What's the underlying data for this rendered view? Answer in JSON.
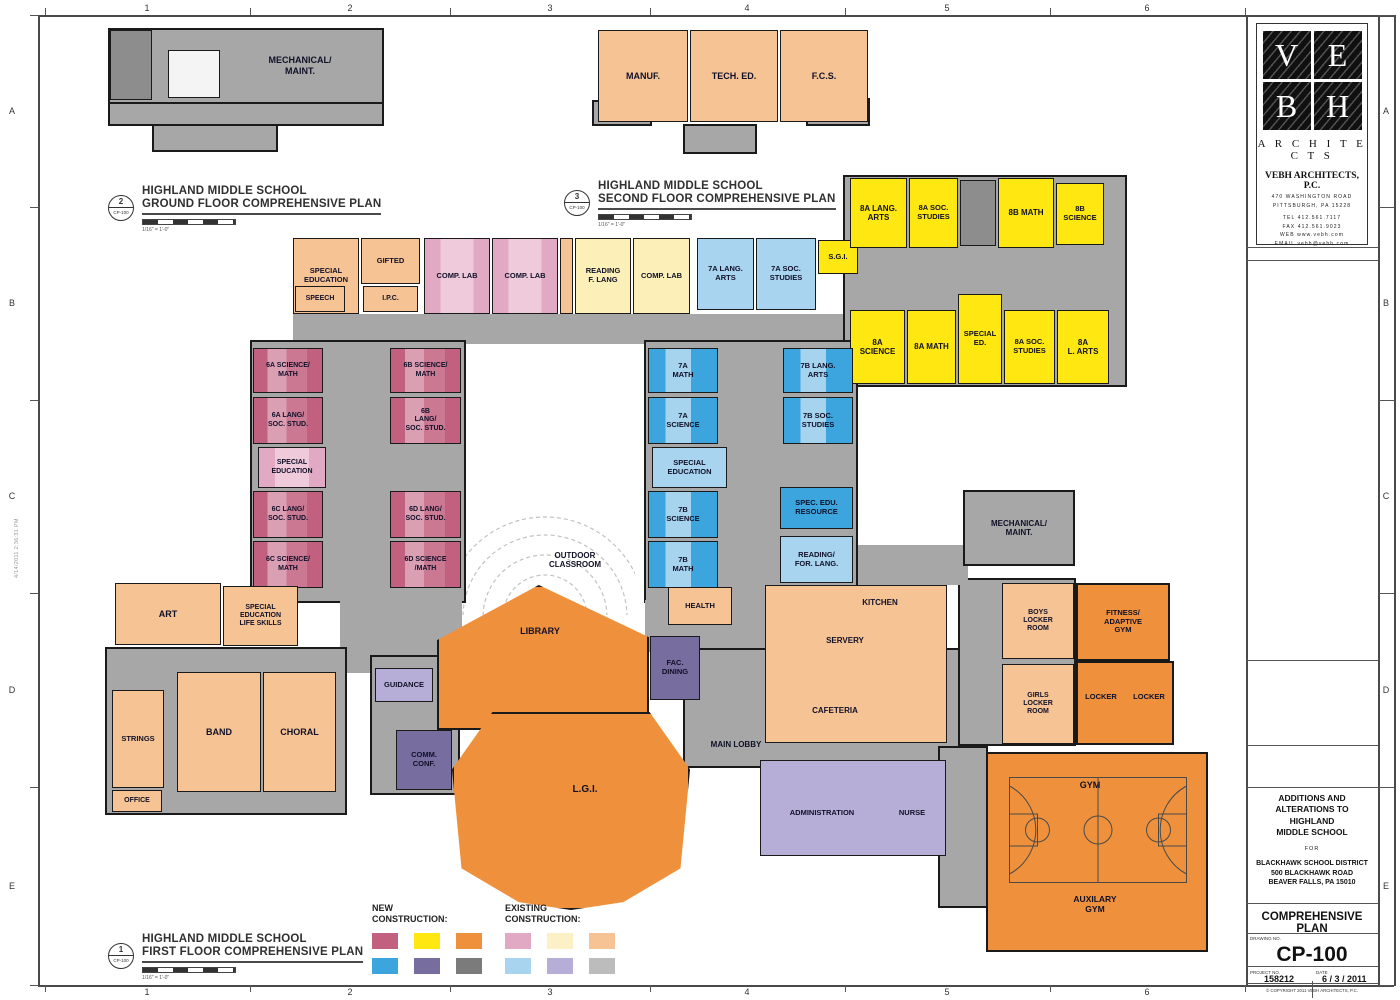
{
  "sheet": {
    "grid_cols": [
      "1",
      "2",
      "3",
      "4",
      "5",
      "6"
    ],
    "grid_rows": [
      "A",
      "B",
      "C",
      "D",
      "E"
    ],
    "stamp": "4/14/2011   2:36:31 PM"
  },
  "titleblock": {
    "logo": [
      "V",
      "E",
      "B",
      "H"
    ],
    "brand": "A R C H I T E C T S",
    "firm": "VEBH ARCHITECTS, P.C.",
    "address1": "470 WASHINGTON ROAD",
    "address2": "PITTSBURGH, PA 15228",
    "tel": "TEL  412.561.7117",
    "fax": "FAX  412.561.9023",
    "web": "WEB  www.vebh.com",
    "email": "EMAIL  vebh@vebh.com",
    "project_title": "ADDITIONS AND\nALTERATIONS TO HIGHLAND\nMIDDLE SCHOOL",
    "for_label": "FOR",
    "client": "BLACKHAWK SCHOOL DISTRICT\n500 BLACKHAWK ROAD\nBEAVER FALLS, PA 15010",
    "sheet_title": "COMPREHENSIVE PLAN",
    "drawing_no_label": "DRAWING NO.",
    "drawing_no": "CP-100",
    "project_no_label": "PROJECT NO.",
    "project_no": "158212",
    "date_label": "DATE",
    "date": "6 / 3 / 2011",
    "copyright": "© COPYRIGHT 2011  VEBH ARCHITECTS, P.C."
  },
  "plan_titles": [
    {
      "num": "2",
      "sheet": "CP-100",
      "line1": "HIGHLAND MIDDLE SCHOOL",
      "line2": "GROUND FLOOR COMPREHENSIVE PLAN",
      "scale": "1/16\" = 1'-0\"",
      "x": 108,
      "y": 185
    },
    {
      "num": "3",
      "sheet": "CP-100",
      "line1": "HIGHLAND MIDDLE SCHOOL",
      "line2": "SECOND FLOOR COMPREHENSIVE PLAN",
      "scale": "1/16\" = 1'-0\"",
      "x": 564,
      "y": 180
    },
    {
      "num": "1",
      "sheet": "CP-100",
      "line1": "HIGHLAND MIDDLE SCHOOL",
      "line2": "FIRST FLOOR COMPREHENSIVE PLAN",
      "scale": "1/16\" = 1'-0\"",
      "x": 108,
      "y": 933
    }
  ],
  "legend": {
    "new_label": "NEW\nCONSTRUCTION:",
    "existing_label": "EXISTING\nCONSTRUCTION:",
    "new_colors": [
      "#c2607f",
      "#ffe712",
      "#ef913c",
      "#3da5dd",
      "#776d9f",
      "#7b7b7b"
    ],
    "existing_colors": [
      "#e2a9c4",
      "#fcf0c6",
      "#f6c494",
      "#a9d4f0",
      "#b6aed6",
      "#bcbcbc"
    ]
  },
  "rooms": [
    {
      "n": "ground-plan-base",
      "x": 108,
      "y": 28,
      "w": 276,
      "h": 76,
      "c": "g"
    },
    {
      "n": "ground-plan-lower",
      "x": 108,
      "y": 102,
      "w": 276,
      "h": 24,
      "c": "g"
    },
    {
      "n": "ground-plan-tab",
      "x": 152,
      "y": 124,
      "w": 126,
      "h": 28,
      "c": "g"
    },
    {
      "n": "ground-room-dark",
      "x": 110,
      "y": 30,
      "w": 42,
      "h": 70,
      "c": "gd"
    },
    {
      "n": "ground-inset",
      "x": 168,
      "y": 50,
      "w": 52,
      "h": 48,
      "c": "w"
    },
    {
      "n": "second-gray-left",
      "x": 592,
      "y": 100,
      "w": 60,
      "h": 26,
      "c": "g"
    },
    {
      "n": "second-gray-right",
      "x": 806,
      "y": 98,
      "w": 64,
      "h": 28,
      "c": "g"
    },
    {
      "n": "second-tab",
      "x": 683,
      "y": 124,
      "w": 74,
      "h": 30,
      "c": "g"
    },
    {
      "n": "strip-corridor",
      "x": 293,
      "y": 314,
      "w": 565,
      "h": 30,
      "c": "gf"
    },
    {
      "n": "yellow-wing-base",
      "x": 843,
      "y": 175,
      "w": 284,
      "h": 212,
      "c": "g"
    },
    {
      "n": "pink-wing-base",
      "x": 250,
      "y": 340,
      "w": 216,
      "h": 263,
      "c": "g"
    },
    {
      "n": "blue-wing-base",
      "x": 644,
      "y": 340,
      "w": 214,
      "h": 263,
      "c": "g"
    },
    {
      "n": "center-connector",
      "x": 340,
      "y": 598,
      "w": 122,
      "h": 75,
      "c": "gf"
    },
    {
      "n": "music-base",
      "x": 105,
      "y": 647,
      "w": 242,
      "h": 168,
      "c": "g"
    },
    {
      "n": "guidance-base",
      "x": 370,
      "y": 655,
      "w": 90,
      "h": 140,
      "c": "g"
    },
    {
      "n": "blue-lobby-connector",
      "x": 645,
      "y": 600,
      "w": 240,
      "h": 52,
      "c": "gf"
    },
    {
      "n": "main-lobby-base",
      "x": 683,
      "y": 648,
      "w": 302,
      "h": 120,
      "c": "g"
    },
    {
      "n": "locker-base",
      "x": 958,
      "y": 578,
      "w": 118,
      "h": 168,
      "c": "g"
    },
    {
      "n": "gym-corridor",
      "x": 938,
      "y": 746,
      "w": 50,
      "h": 162,
      "c": "g"
    },
    {
      "n": "mech-connector",
      "x": 858,
      "y": 545,
      "w": 110,
      "h": 40,
      "c": "gf"
    },
    {
      "n": "mechanical-maint-first",
      "x": 963,
      "y": 490,
      "w": 112,
      "h": 76,
      "c": "g",
      "l": "MECHANICAL/\nMAINT.",
      "fs": 8
    },
    {
      "n": "manuf",
      "x": 598,
      "y": 30,
      "w": 90,
      "h": 92,
      "c": "ore",
      "l": "MANUF.",
      "fs": 9
    },
    {
      "n": "tech-ed",
      "x": 690,
      "y": 30,
      "w": 88,
      "h": 92,
      "c": "ore",
      "l": "TECH. ED.",
      "fs": 9
    },
    {
      "n": "fcs",
      "x": 780,
      "y": 30,
      "w": 88,
      "h": 92,
      "c": "ore",
      "l": "F.C.S.",
      "fs": 9
    },
    {
      "n": "special-education-2f",
      "x": 293,
      "y": 238,
      "w": 66,
      "h": 76,
      "c": "ore",
      "l": "SPECIAL\nEDUCATION",
      "fs": 7.5
    },
    {
      "n": "gifted",
      "x": 361,
      "y": 238,
      "w": 59,
      "h": 46,
      "c": "ore",
      "l": "GIFTED",
      "fs": 7.5
    },
    {
      "n": "speech",
      "x": 295,
      "y": 286,
      "w": 50,
      "h": 26,
      "c": "ore",
      "l": "SPEECH",
      "fs": 7
    },
    {
      "n": "ipc",
      "x": 363,
      "y": 286,
      "w": 55,
      "h": 26,
      "c": "ore",
      "l": "I.P.C.",
      "fs": 7
    },
    {
      "n": "comp-lab-1",
      "x": 424,
      "y": 238,
      "w": 66,
      "h": 76,
      "c": "pke",
      "l": "COMP. LAB",
      "fs": 7.5
    },
    {
      "n": "comp-lab-2",
      "x": 492,
      "y": 238,
      "w": 66,
      "h": 76,
      "c": "pke",
      "l": "COMP. LAB",
      "fs": 7.5
    },
    {
      "n": "strip-gap",
      "x": 560,
      "y": 238,
      "w": 13,
      "h": 76,
      "c": "ore"
    },
    {
      "n": "reading-f-lang",
      "x": 575,
      "y": 238,
      "w": 56,
      "h": 76,
      "c": "yle",
      "l": "READING\nF. LANG",
      "fs": 7.5
    },
    {
      "n": "comp-lab-3",
      "x": 633,
      "y": 238,
      "w": 57,
      "h": 76,
      "c": "yle",
      "l": "COMP. LAB",
      "fs": 7.5
    },
    {
      "n": "lang-arts-7a",
      "x": 697,
      "y": 238,
      "w": 57,
      "h": 72,
      "c": "ble",
      "l": "7A LANG.\nARTS",
      "fs": 7.5
    },
    {
      "n": "soc-studies-7a",
      "x": 756,
      "y": 238,
      "w": 60,
      "h": 72,
      "c": "ble",
      "l": "7A SOC.\nSTUDIES",
      "fs": 7.5
    },
    {
      "n": "sgi",
      "x": 818,
      "y": 240,
      "w": 40,
      "h": 34,
      "c": "yln",
      "l": "S.G.I.",
      "fs": 7.5
    },
    {
      "n": "lang-arts-8a",
      "x": 850,
      "y": 178,
      "w": 57,
      "h": 70,
      "c": "yln",
      "l": "8A LANG.\nARTS",
      "fs": 8
    },
    {
      "n": "soc-studies-8a-north",
      "x": 909,
      "y": 178,
      "w": 49,
      "h": 70,
      "c": "yln",
      "l": "8A SOC.\nSTUDIES",
      "fs": 7.5
    },
    {
      "n": "stair-core-8",
      "x": 960,
      "y": 180,
      "w": 36,
      "h": 66,
      "c": "gd"
    },
    {
      "n": "math-8b",
      "x": 998,
      "y": 178,
      "w": 56,
      "h": 70,
      "c": "yln",
      "l": "8B MATH",
      "fs": 8
    },
    {
      "n": "science-8b",
      "x": 1056,
      "y": 183,
      "w": 48,
      "h": 62,
      "c": "yln",
      "l": "8B\nSCIENCE",
      "fs": 7.5
    },
    {
      "n": "science-8a",
      "x": 850,
      "y": 310,
      "w": 55,
      "h": 74,
      "c": "yln",
      "l": "8A\nSCIENCE",
      "fs": 8
    },
    {
      "n": "math-8a",
      "x": 907,
      "y": 310,
      "w": 49,
      "h": 74,
      "c": "yln",
      "l": "8A MATH",
      "fs": 8
    },
    {
      "n": "special-ed-8",
      "x": 958,
      "y": 294,
      "w": 44,
      "h": 90,
      "c": "yln",
      "l": "SPECIAL\nED.",
      "fs": 7.5
    },
    {
      "n": "soc-studies-8a-south",
      "x": 1004,
      "y": 310,
      "w": 51,
      "h": 74,
      "c": "yln",
      "l": "8A SOC.\nSTUDIES",
      "fs": 7.5
    },
    {
      "n": "lang-arts-8a-south",
      "x": 1057,
      "y": 310,
      "w": 52,
      "h": 74,
      "c": "yln",
      "l": "8A\nL. ARTS",
      "fs": 8
    },
    {
      "n": "science-math-6a",
      "x": 253,
      "y": 348,
      "w": 70,
      "h": 45,
      "c": "pks",
      "l": "6A SCIENCE/\nMATH",
      "fs": 7
    },
    {
      "n": "science-math-6b",
      "x": 390,
      "y": 348,
      "w": 71,
      "h": 45,
      "c": "pks",
      "l": "6B SCIENCE/\nMATH",
      "fs": 7
    },
    {
      "n": "lang-soc-6a",
      "x": 253,
      "y": 397,
      "w": 70,
      "h": 47,
      "c": "pks",
      "l": "6A LANG/\nSOC. STUD.",
      "fs": 7
    },
    {
      "n": "lang-soc-6b",
      "x": 390,
      "y": 397,
      "w": 71,
      "h": 47,
      "c": "pks",
      "l": "6B\nLANG/\nSOC. STUD.",
      "fs": 7
    },
    {
      "n": "special-education-6",
      "x": 258,
      "y": 447,
      "w": 68,
      "h": 41,
      "c": "pke",
      "l": "SPECIAL\nEDUCATION",
      "fs": 7
    },
    {
      "n": "core-6",
      "x": 390,
      "y": 447,
      "w": 71,
      "h": 41,
      "c": "gf"
    },
    {
      "n": "lang-soc-6c",
      "x": 253,
      "y": 491,
      "w": 70,
      "h": 47,
      "c": "pks",
      "l": "6C LANG/\nSOC. STUD.",
      "fs": 7
    },
    {
      "n": "lang-soc-6d",
      "x": 390,
      "y": 491,
      "w": 71,
      "h": 47,
      "c": "pks",
      "l": "6D LANG/\nSOC. STUD.",
      "fs": 7
    },
    {
      "n": "science-math-6c",
      "x": 253,
      "y": 541,
      "w": 70,
      "h": 47,
      "c": "pks",
      "l": "6C SCIENCE/\nMATH",
      "fs": 7
    },
    {
      "n": "science-math-6d",
      "x": 390,
      "y": 541,
      "w": 71,
      "h": 47,
      "c": "pks",
      "l": "6D SCIENCE\n/MATH",
      "fs": 7
    },
    {
      "n": "math-7a",
      "x": 648,
      "y": 348,
      "w": 70,
      "h": 45,
      "c": "bls",
      "l": "7A\nMATH",
      "fs": 7.5
    },
    {
      "n": "lang-arts-7b",
      "x": 783,
      "y": 348,
      "w": 70,
      "h": 45,
      "c": "bls",
      "l": "7B LANG.\nARTS",
      "fs": 7.5
    },
    {
      "n": "science-7a",
      "x": 648,
      "y": 397,
      "w": 70,
      "h": 47,
      "c": "bls",
      "l": "7A\nSCIENCE",
      "fs": 7.5
    },
    {
      "n": "soc-studies-7b",
      "x": 783,
      "y": 397,
      "w": 70,
      "h": 47,
      "c": "bls",
      "l": "7B SOC.\nSTUDIES",
      "fs": 7.5
    },
    {
      "n": "special-education-7",
      "x": 652,
      "y": 447,
      "w": 75,
      "h": 41,
      "c": "ble",
      "l": "SPECIAL\nEDUCATION",
      "fs": 7.5
    },
    {
      "n": "science-7b",
      "x": 648,
      "y": 491,
      "w": 70,
      "h": 47,
      "c": "bls",
      "l": "7B\nSCIENCE",
      "fs": 7.5
    },
    {
      "n": "spec-edu-resource",
      "x": 780,
      "y": 487,
      "w": 73,
      "h": 42,
      "c": "bln",
      "l": "SPEC. EDU.\nRESOURCE",
      "fs": 7.5
    },
    {
      "n": "math-7b",
      "x": 648,
      "y": 541,
      "w": 70,
      "h": 47,
      "c": "bls",
      "l": "7B\nMATH",
      "fs": 7.5
    },
    {
      "n": "reading-for-lang",
      "x": 780,
      "y": 536,
      "w": 73,
      "h": 47,
      "c": "ble",
      "l": "READING/\nFOR. LANG.",
      "fs": 7.5
    },
    {
      "n": "art",
      "x": 115,
      "y": 583,
      "w": 106,
      "h": 62,
      "c": "ore",
      "l": "ART",
      "fs": 9
    },
    {
      "n": "special-education-life-skills",
      "x": 223,
      "y": 586,
      "w": 75,
      "h": 60,
      "c": "ore",
      "l": "SPECIAL\nEDUCATION\nLIFE SKILLS",
      "fs": 7
    },
    {
      "n": "strings",
      "x": 112,
      "y": 690,
      "w": 52,
      "h": 98,
      "c": "ore",
      "l": "STRINGS",
      "fs": 7.5
    },
    {
      "n": "band",
      "x": 177,
      "y": 672,
      "w": 84,
      "h": 120,
      "c": "ore",
      "l": "BAND",
      "fs": 9
    },
    {
      "n": "choral",
      "x": 263,
      "y": 672,
      "w": 73,
      "h": 120,
      "c": "ore",
      "l": "CHORAL",
      "fs": 9
    },
    {
      "n": "office",
      "x": 112,
      "y": 790,
      "w": 50,
      "h": 22,
      "c": "ore",
      "l": "OFFICE",
      "fs": 7
    },
    {
      "n": "guidance",
      "x": 375,
      "y": 668,
      "w": 58,
      "h": 34,
      "c": "pue",
      "l": "GUIDANCE",
      "fs": 7.5
    },
    {
      "n": "comm-conf",
      "x": 396,
      "y": 730,
      "w": 56,
      "h": 60,
      "c": "pun",
      "l": "COMM.\nCONF.",
      "fs": 7.5
    },
    {
      "n": "library",
      "x": 437,
      "y": 585,
      "w": 212,
      "h": 145,
      "c": "orn",
      "clip": "polygon(48% 0%, 100% 36%, 100% 100%, 0% 100%, 0% 38%)"
    },
    {
      "n": "library-label",
      "x": 495,
      "y": 624,
      "w": 90,
      "h": 14,
      "c": "lbl",
      "l": "LIBRARY",
      "fs": 9
    },
    {
      "n": "fac-dining",
      "x": 650,
      "y": 636,
      "w": 50,
      "h": 64,
      "c": "pun",
      "l": "FAC.\nDINING",
      "fs": 7.5
    },
    {
      "n": "health",
      "x": 668,
      "y": 587,
      "w": 64,
      "h": 38,
      "c": "ore",
      "l": "HEALTH",
      "fs": 7.5
    },
    {
      "n": "lgi",
      "x": 452,
      "y": 712,
      "w": 238,
      "h": 198,
      "c": "orn",
      "clip": "polygon(17% 0%, 83% 0%, 100% 29%, 96% 79%, 72% 96%, 50% 100%, 28% 96%, 4% 79%, 0% 29%)"
    },
    {
      "n": "lgi-label",
      "x": 540,
      "y": 782,
      "w": 90,
      "h": 16,
      "c": "lbl",
      "l": "L.G.I.",
      "fs": 10
    },
    {
      "n": "kitchen-cafeteria-block",
      "x": 765,
      "y": 585,
      "w": 182,
      "h": 158,
      "c": "ore"
    },
    {
      "n": "kitchen-label",
      "x": 835,
      "y": 596,
      "w": 90,
      "h": 14,
      "c": "lbl",
      "l": "KITCHEN",
      "fs": 8
    },
    {
      "n": "servery-label",
      "x": 800,
      "y": 634,
      "w": 90,
      "h": 14,
      "c": "lbl",
      "l": "SERVERY",
      "fs": 8
    },
    {
      "n": "cafeteria-label",
      "x": 790,
      "y": 704,
      "w": 90,
      "h": 14,
      "c": "lbl",
      "l": "CAFETERIA",
      "fs": 8
    },
    {
      "n": "boys-locker-room",
      "x": 1002,
      "y": 583,
      "w": 72,
      "h": 76,
      "c": "ore",
      "l": "BOYS\nLOCKER\nROOM",
      "fs": 7
    },
    {
      "n": "girls-locker-room",
      "x": 1002,
      "y": 664,
      "w": 72,
      "h": 80,
      "c": "ore",
      "l": "GIRLS\nLOCKER\nROOM",
      "fs": 7
    },
    {
      "n": "fitness-adaptive-gym",
      "x": 1076,
      "y": 583,
      "w": 94,
      "h": 78,
      "c": "orn",
      "l": "FITNESS/\nADAPTIVE\nGYM",
      "fs": 7.5
    },
    {
      "n": "locker-block",
      "x": 1076,
      "y": 661,
      "w": 98,
      "h": 84,
      "c": "orn"
    },
    {
      "n": "locker-1-label",
      "x": 1078,
      "y": 690,
      "w": 46,
      "h": 14,
      "c": "lbl",
      "l": "LOCKER",
      "fs": 7.5
    },
    {
      "n": "locker-2-label",
      "x": 1126,
      "y": 690,
      "w": 46,
      "h": 14,
      "c": "lbl",
      "l": "LOCKER",
      "fs": 7.5
    },
    {
      "n": "gym-block",
      "x": 986,
      "y": 752,
      "w": 222,
      "h": 200,
      "c": "orn"
    },
    {
      "n": "gym-label",
      "x": 1060,
      "y": 778,
      "w": 60,
      "h": 14,
      "c": "lbl",
      "l": "GYM",
      "fs": 9
    },
    {
      "n": "auxilary-gym-label",
      "x": 1050,
      "y": 891,
      "w": 90,
      "h": 26,
      "c": "lbl",
      "l": "AUXILARY\nGYM",
      "fs": 8.5
    },
    {
      "n": "administration-block",
      "x": 760,
      "y": 760,
      "w": 186,
      "h": 96,
      "c": "pue"
    },
    {
      "n": "administration-label",
      "x": 766,
      "y": 806,
      "w": 112,
      "h": 14,
      "c": "lbl",
      "l": "ADMINISTRATION",
      "fs": 7.5
    },
    {
      "n": "nurse-label",
      "x": 886,
      "y": 806,
      "w": 52,
      "h": 14,
      "c": "lbl",
      "l": "NURSE",
      "fs": 7.5
    },
    {
      "n": "main-lobby-label",
      "x": 690,
      "y": 738,
      "w": 92,
      "h": 14,
      "c": "lbl",
      "l": "MAIN LOBBY",
      "fs": 8
    },
    {
      "n": "outdoor-classroom-label",
      "x": 520,
      "y": 546,
      "w": 110,
      "h": 28,
      "c": "lbl",
      "l": "OUTDOOR\nCLASSROOM",
      "fs": 8
    },
    {
      "n": "mechanical-maint-ground-label",
      "x": 245,
      "y": 48,
      "w": 110,
      "h": 36,
      "c": "lbl",
      "l": "MECHANICAL/\nMAINT.",
      "fs": 9
    }
  ]
}
